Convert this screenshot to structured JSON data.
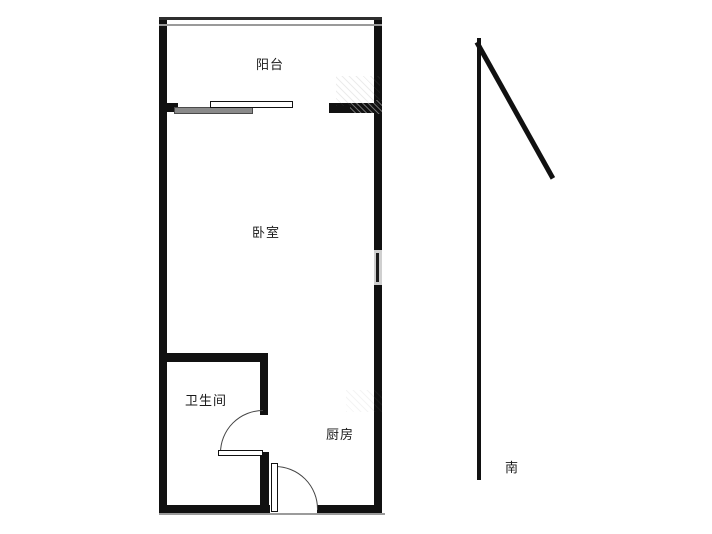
{
  "plan": {
    "type": "apartment-floor-plan",
    "rooms": {
      "balcony": "阳台",
      "bedroom": "卧室",
      "bathroom": "卫生间",
      "kitchen": "厨房"
    },
    "compass": {
      "south": "南"
    },
    "colors": {
      "wall": "#111111",
      "background": "#ffffff",
      "window_line_dark": "#2e2e2e",
      "window_line_light": "#9a9a9a",
      "sliding_panel_gray": "#8a8a8a",
      "door_arc": "#444444",
      "bottom_shadow": "#9b9b9b",
      "bedroom_window_fill": "#cfcfcf"
    }
  }
}
